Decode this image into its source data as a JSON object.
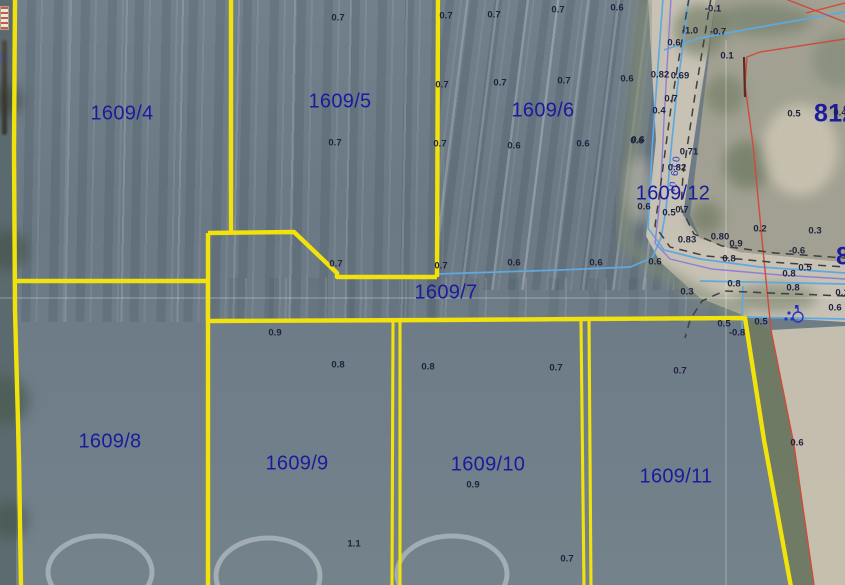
{
  "map": {
    "road_label": "019 út",
    "colors": {
      "boundary_yellow": "#f2e20c",
      "parcel_label_blue": "#1b1b9e",
      "measurement_text": "#20233f",
      "water_blue": "#5fa8e0",
      "violet_line": "#8f7fd4",
      "boundary_red": "#cf4b3a",
      "road_dash": "#3f3f3f",
      "symbol_blue": "#2a2fc8"
    },
    "parcel_labels": [
      {
        "text": "1609/4",
        "x": 122,
        "y": 114
      },
      {
        "text": "1609/5",
        "x": 340,
        "y": 102
      },
      {
        "text": "1609/6",
        "x": 543,
        "y": 111
      },
      {
        "text": "1609/12",
        "x": 673,
        "y": 194
      },
      {
        "text": "1609/7",
        "x": 446,
        "y": 293
      },
      {
        "text": "1609/8",
        "x": 110,
        "y": 442
      },
      {
        "text": "1609/9",
        "x": 297,
        "y": 464
      },
      {
        "text": "1609/10",
        "x": 488,
        "y": 465
      },
      {
        "text": "1609/11",
        "x": 676,
        "y": 477
      },
      {
        "text": "812",
        "x": 814,
        "y": 114,
        "large": true,
        "edge": true
      },
      {
        "text": "82",
        "x": 836,
        "y": 257,
        "large": true,
        "edge": true
      }
    ],
    "measurements": [
      {
        "t": "0.7",
        "x": 338,
        "y": 18
      },
      {
        "t": "0.7",
        "x": 335,
        "y": 143
      },
      {
        "t": "0.7",
        "x": 446,
        "y": 16
      },
      {
        "t": "0.7",
        "x": 442,
        "y": 85
      },
      {
        "t": "0.7",
        "x": 440,
        "y": 144
      },
      {
        "t": "0.7",
        "x": 494,
        "y": 15
      },
      {
        "t": "0.7",
        "x": 558,
        "y": 10
      },
      {
        "t": "0.6",
        "x": 617,
        "y": 8
      },
      {
        "t": "0.7",
        "x": 500,
        "y": 83
      },
      {
        "t": "0.7",
        "x": 564,
        "y": 81
      },
      {
        "t": "0.6",
        "x": 627,
        "y": 79
      },
      {
        "t": "0.6",
        "x": 514,
        "y": 146
      },
      {
        "t": "0.6",
        "x": 583,
        "y": 144
      },
      {
        "t": "0.6",
        "x": 637,
        "y": 141
      },
      {
        "t": "0.4",
        "x": 840,
        "y": 113
      },
      {
        "t": "-0.1",
        "x": 713,
        "y": 9
      },
      {
        "t": "-1.0",
        "x": 690,
        "y": 31
      },
      {
        "t": "-0.7",
        "x": 718,
        "y": 32
      },
      {
        "t": "0.6",
        "x": 674,
        "y": 43
      },
      {
        "t": "0.1",
        "x": 727,
        "y": 56
      },
      {
        "t": "0.82",
        "x": 660,
        "y": 75
      },
      {
        "t": "0.69",
        "x": 680,
        "y": 76
      },
      {
        "t": "0.7",
        "x": 671,
        "y": 99
      },
      {
        "t": "0.4",
        "x": 659,
        "y": 111
      },
      {
        "t": "0.6",
        "x": 638,
        "y": 140
      },
      {
        "t": "0.71",
        "x": 689,
        "y": 152
      },
      {
        "t": "0.82",
        "x": 677,
        "y": 168
      },
      {
        "t": "0.5",
        "x": 794,
        "y": 114
      },
      {
        "t": "0.6",
        "x": 644,
        "y": 207
      },
      {
        "t": "0.5",
        "x": 669,
        "y": 213
      },
      {
        "t": "0.7",
        "x": 682,
        "y": 210
      },
      {
        "t": "0.83",
        "x": 687,
        "y": 240
      },
      {
        "t": "0.80",
        "x": 720,
        "y": 237
      },
      {
        "t": "0.9",
        "x": 736,
        "y": 244
      },
      {
        "t": "0.2",
        "x": 760,
        "y": 229
      },
      {
        "t": "0.3",
        "x": 815,
        "y": 231
      },
      {
        "t": "-0.6",
        "x": 797,
        "y": 251
      },
      {
        "t": "0.8",
        "x": 729,
        "y": 259
      },
      {
        "t": "0.5",
        "x": 805,
        "y": 268
      },
      {
        "t": "0.8",
        "x": 789,
        "y": 274
      },
      {
        "t": "0.8",
        "x": 734,
        "y": 284
      },
      {
        "t": "0.8",
        "x": 793,
        "y": 288
      },
      {
        "t": "0.1",
        "x": 842,
        "y": 293
      },
      {
        "t": "0.3",
        "x": 687,
        "y": 292
      },
      {
        "t": "0.6",
        "x": 835,
        "y": 308
      },
      {
        "t": "0.5",
        "x": 724,
        "y": 324
      },
      {
        "t": "0.5",
        "x": 761,
        "y": 322
      },
      {
        "t": "-0.8",
        "x": 737,
        "y": 333
      },
      {
        "t": "0.7",
        "x": 336,
        "y": 264
      },
      {
        "t": "0.7",
        "x": 441,
        "y": 266
      },
      {
        "t": "0.6",
        "x": 514,
        "y": 263
      },
      {
        "t": "0.6",
        "x": 596,
        "y": 263
      },
      {
        "t": "0.6",
        "x": 655,
        "y": 262
      },
      {
        "t": "0.9",
        "x": 275,
        "y": 333
      },
      {
        "t": "0.8",
        "x": 338,
        "y": 365
      },
      {
        "t": "0.8",
        "x": 428,
        "y": 367
      },
      {
        "t": "0.7",
        "x": 556,
        "y": 368
      },
      {
        "t": "0.9",
        "x": 473,
        "y": 485
      },
      {
        "t": "1.1",
        "x": 354,
        "y": 544
      },
      {
        "t": "0.7",
        "x": 567,
        "y": 559
      },
      {
        "t": "0.7",
        "x": 680,
        "y": 371
      },
      {
        "t": "0.6",
        "x": 797,
        "y": 443
      }
    ]
  }
}
